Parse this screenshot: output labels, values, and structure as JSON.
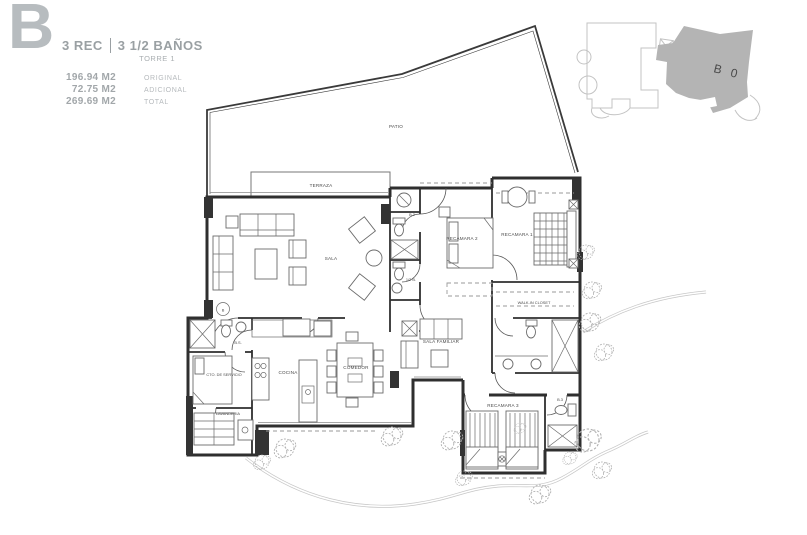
{
  "header": {
    "plan_letter": "B",
    "title_rec": "3 REC",
    "title_banos": "3 1/2 BAÑOS",
    "tower": "TORRE 1",
    "areas": [
      {
        "value": "196.94 M2",
        "label": "ORIGINAL"
      },
      {
        "value": "72.75 M2",
        "label": "ADICIONAL"
      },
      {
        "value": "269.69 M2",
        "label": "TOTAL"
      }
    ]
  },
  "keyplan": {
    "unit_label": "B 0"
  },
  "floorplan": {
    "door_marker": "B",
    "rooms": {
      "patio": "PATIO",
      "terraza": "TERRAZA",
      "sala": "SALA",
      "comedor": "COMEDOR",
      "cocina": "COCINA",
      "lavanderia": "LAVANDERIA",
      "cto_servicio": "CTO. DE SERVICIO",
      "bano_servicio": "B.S.",
      "sala_familiar": "SALA FAMILIAR",
      "recamara_1": "RECAMARA 1",
      "recamara_2": "RECAMARA 2",
      "recamara_3": "RECAMARA 3",
      "walk_in_closet": "WALK-IN CLOSET",
      "bano_2": "B.2",
      "bano_3": "B.3",
      "medio_bano": "1/2 B."
    }
  }
}
